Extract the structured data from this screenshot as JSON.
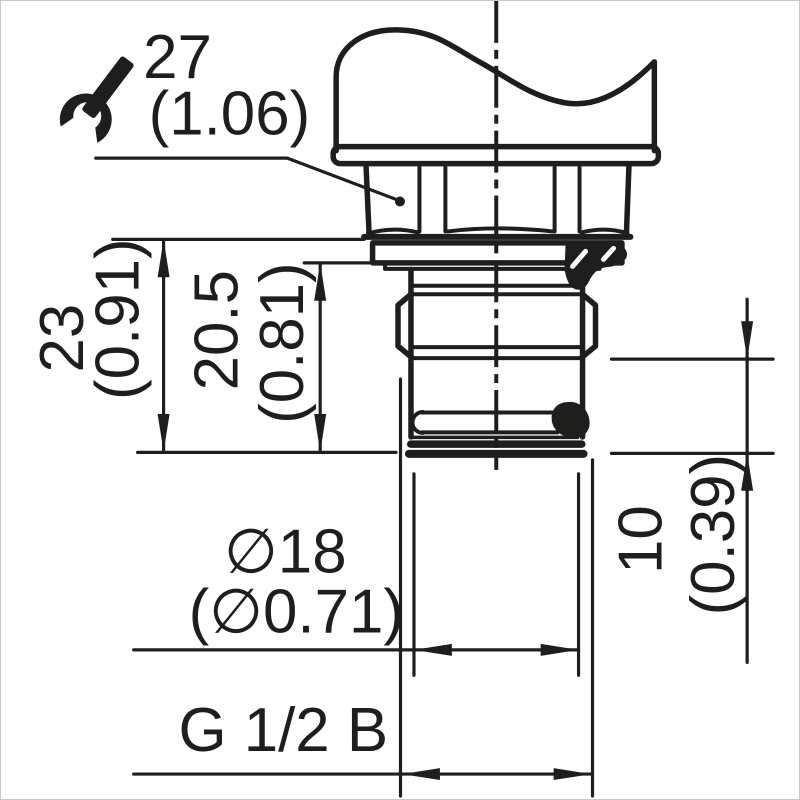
{
  "drawing": {
    "type": "engineering-dimension-drawing",
    "subject": "threaded process connection (sensor fitting), front view with break line",
    "colors": {
      "ink": "#1e1e1c",
      "background": "#ffffff",
      "frame_border": "#c9c9c9"
    },
    "icons": [
      {
        "name": "wrench-icon",
        "meaning": "wrench size / hex across flats"
      }
    ],
    "dims": {
      "wrench": {
        "metric": "27",
        "inch": "(1.06)"
      },
      "h23": {
        "metric": "23",
        "inch": "(0.91)"
      },
      "h205": {
        "metric": "20.5",
        "inch": "(0.81)"
      },
      "h10": {
        "metric": "10",
        "inch": "(0.39)"
      },
      "d18": {
        "metric": "∅18",
        "inch": "(∅0.71)"
      },
      "thread": {
        "metric": "G 1/2 B"
      }
    }
  }
}
